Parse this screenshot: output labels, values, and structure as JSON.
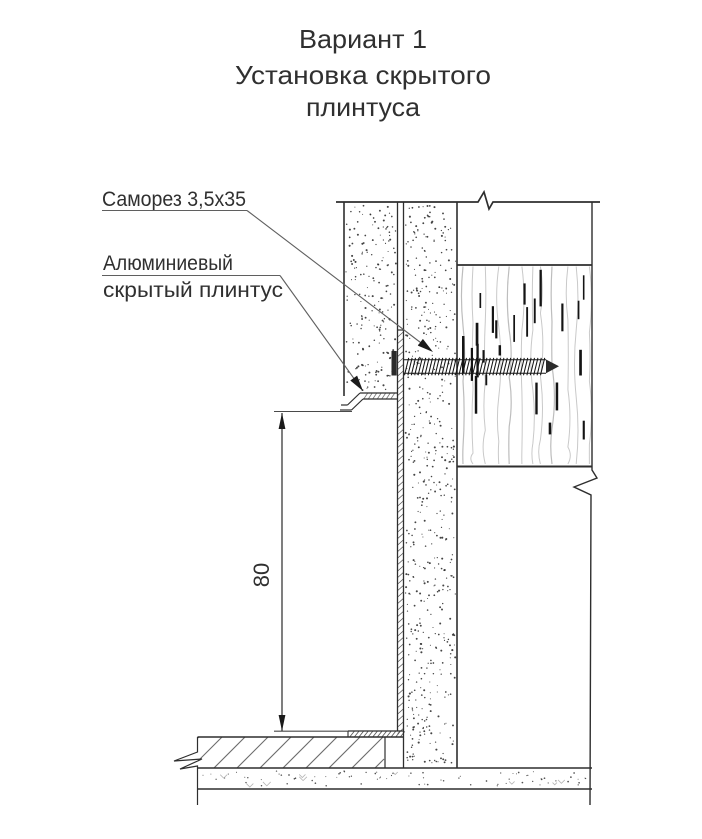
{
  "title": {
    "line1": "Вариант 1",
    "line2": "Установка скрытого",
    "line3": "плинтуса"
  },
  "callouts": {
    "screw_label": "Саморез 3,5x35",
    "plinth_label_line1": "Алюминиевый",
    "plinth_label_line2": "скрытый плинтус"
  },
  "dimension": {
    "plinth_recess_height": "80"
  },
  "colors": {
    "line": "#2e2e2e",
    "leader": "#666666",
    "wood_grain": "#c9c9c9",
    "background": "#ffffff"
  }
}
